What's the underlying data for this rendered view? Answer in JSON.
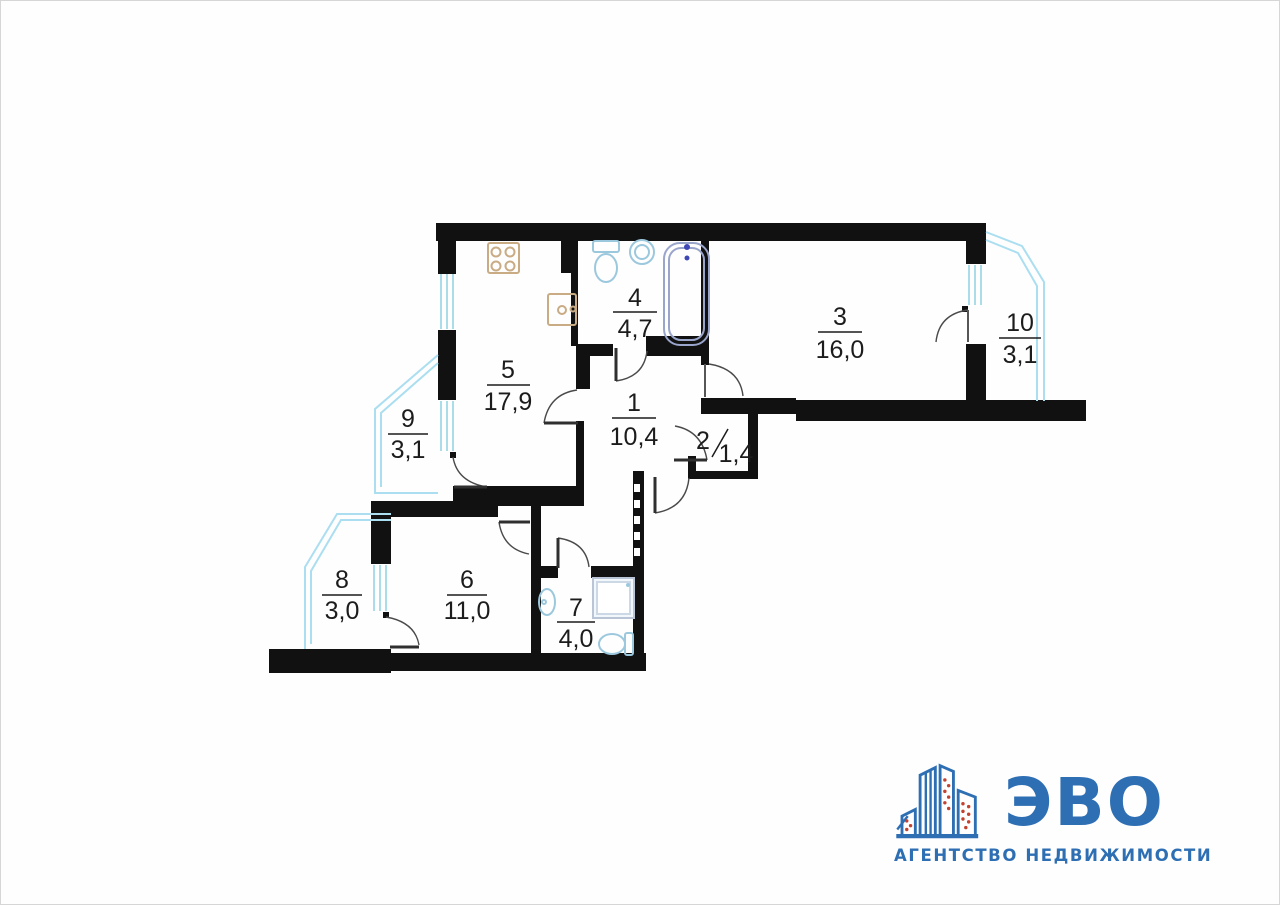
{
  "page": {
    "background_color": "#fefefe",
    "border_color": "#d6d6d6"
  },
  "floor_plan": {
    "wall_color": "#111111",
    "balcony_outline_color": "#aadef0",
    "window_line_color": "#8fd0e2",
    "door_arc_color": "#4a4a4a",
    "label_color": "#1c1c1c",
    "kitchen_fixture_color": "#c9ab84",
    "sanitary_fixture_color": "#9cc8de",
    "bathtub_color": "#9aa5cb",
    "rooms": [
      {
        "number": "1",
        "area": "10,4"
      },
      {
        "number": "2",
        "area": "1,4"
      },
      {
        "number": "3",
        "area": "16,0"
      },
      {
        "number": "4",
        "area": "4,7"
      },
      {
        "number": "5",
        "area": "17,9"
      },
      {
        "number": "6",
        "area": "11,0"
      },
      {
        "number": "7",
        "area": "4,0"
      },
      {
        "number": "8",
        "area": "3,0"
      },
      {
        "number": "9",
        "area": "3,1"
      },
      {
        "number": "10",
        "area": "3,1"
      }
    ]
  },
  "logo": {
    "brand": "ЭВО",
    "tagline": "АГЕНТСТВО НЕДВИЖИМОСТИ",
    "brand_color": "#2e6fb4",
    "window_dot_color": "#c2412f"
  }
}
